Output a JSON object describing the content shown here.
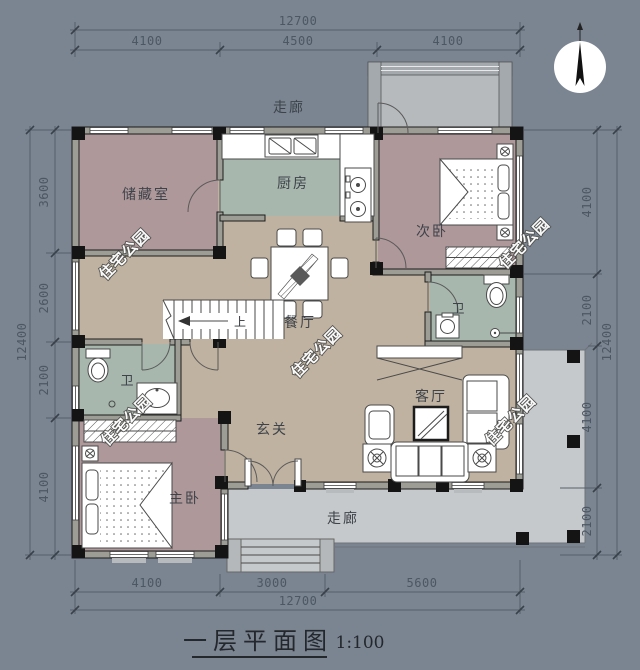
{
  "title": {
    "text": "一层平面图",
    "scale": "1:100"
  },
  "watermark": {
    "text": "住宅公园"
  },
  "stairs": {
    "direction_label": "上"
  },
  "compass": {
    "icon": "north-arrow"
  },
  "rooms": [
    {
      "id": "storage",
      "label": "储藏室"
    },
    {
      "id": "kitchen",
      "label": "厨房"
    },
    {
      "id": "bedroom-second",
      "label": "次卧"
    },
    {
      "id": "dining",
      "label": "餐厅"
    },
    {
      "id": "bath-right",
      "label": "卫"
    },
    {
      "id": "living",
      "label": "客厅"
    },
    {
      "id": "foyer",
      "label": "玄关"
    },
    {
      "id": "bath-left",
      "label": "卫"
    },
    {
      "id": "bedroom-master",
      "label": "主卧"
    },
    {
      "id": "corridor-top",
      "label": "走廊"
    },
    {
      "id": "porch-bottom",
      "label": "走廊"
    }
  ],
  "dimensions": {
    "top": {
      "total": "12700",
      "segments": [
        "4100",
        "4500",
        "4100"
      ]
    },
    "bottom": {
      "total": "12700",
      "segments": [
        "4100",
        "3000",
        "5600"
      ]
    },
    "left": {
      "total": "12400",
      "segments": [
        "3600",
        "2600",
        "2100",
        "4100"
      ]
    },
    "right": {
      "total": "12400",
      "segments": [
        "4100",
        "2100",
        "4100",
        "2100"
      ]
    }
  },
  "colors": {
    "background": "#7a8591",
    "room_mauve": "#ae989a",
    "room_green": "#a7b7ad",
    "room_tan": "#bfb2a0",
    "porch_gray": "#c6c9cb",
    "wall_gray": "#9d9d95",
    "wall_black": "#141414"
  }
}
